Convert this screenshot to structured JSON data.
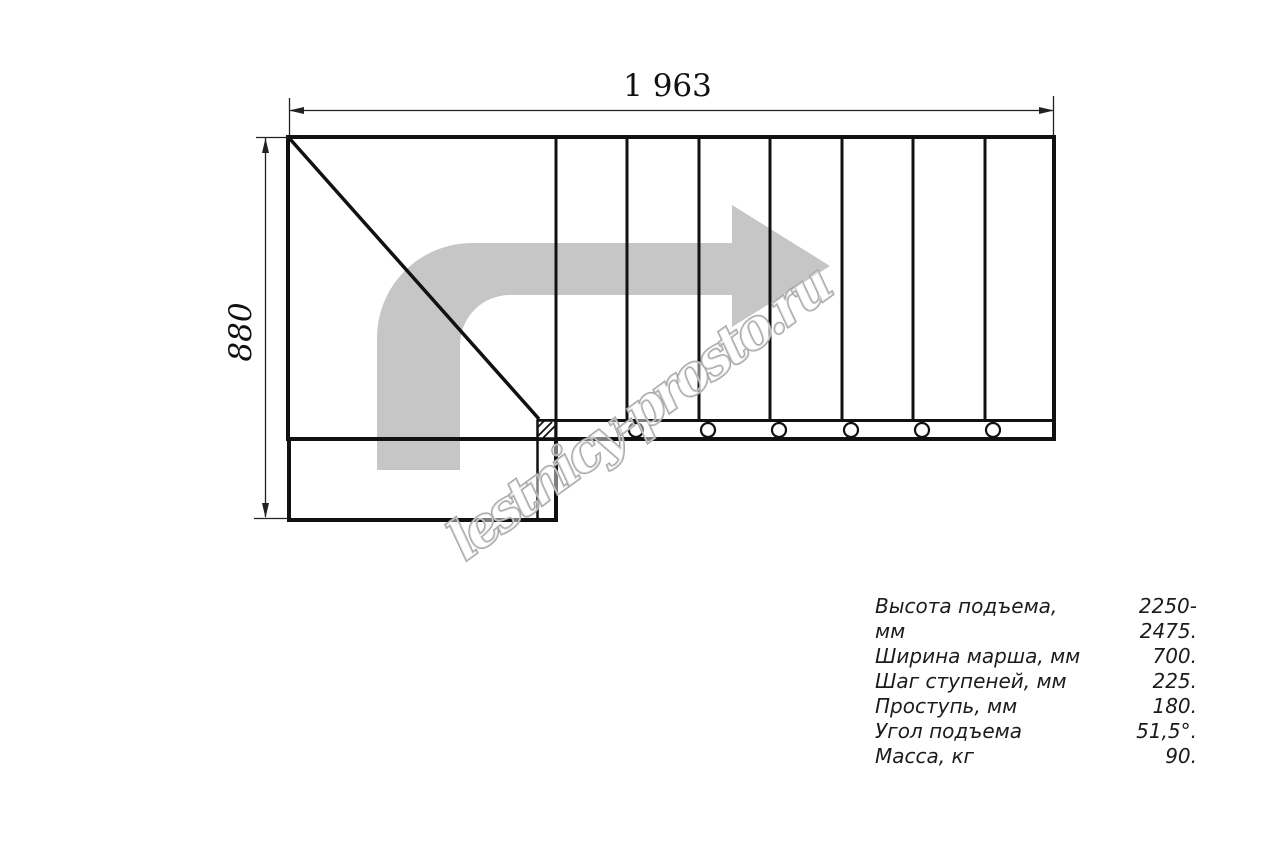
{
  "drawing": {
    "width_dim": "1 963",
    "height_dim": "880",
    "watermark": "lestnicy-prosto.ru",
    "colors": {
      "line": "#111111",
      "dimension_line": "#222222",
      "arrow_gray": "#c6c6c6",
      "watermark_gray": "#a3a3a3"
    }
  },
  "specs": {
    "rows": [
      {
        "label": "Высота подъема, мм",
        "value": "2250-2475."
      },
      {
        "label": "Ширина марша, мм",
        "value": "700."
      },
      {
        "label": "Шаг ступеней, мм",
        "value": "225."
      },
      {
        "label": "Проступь, мм",
        "value": "180."
      },
      {
        "label": "Угол подъема",
        "value": "51,5°."
      },
      {
        "label": "Масса, кг",
        "value": "90."
      }
    ]
  }
}
